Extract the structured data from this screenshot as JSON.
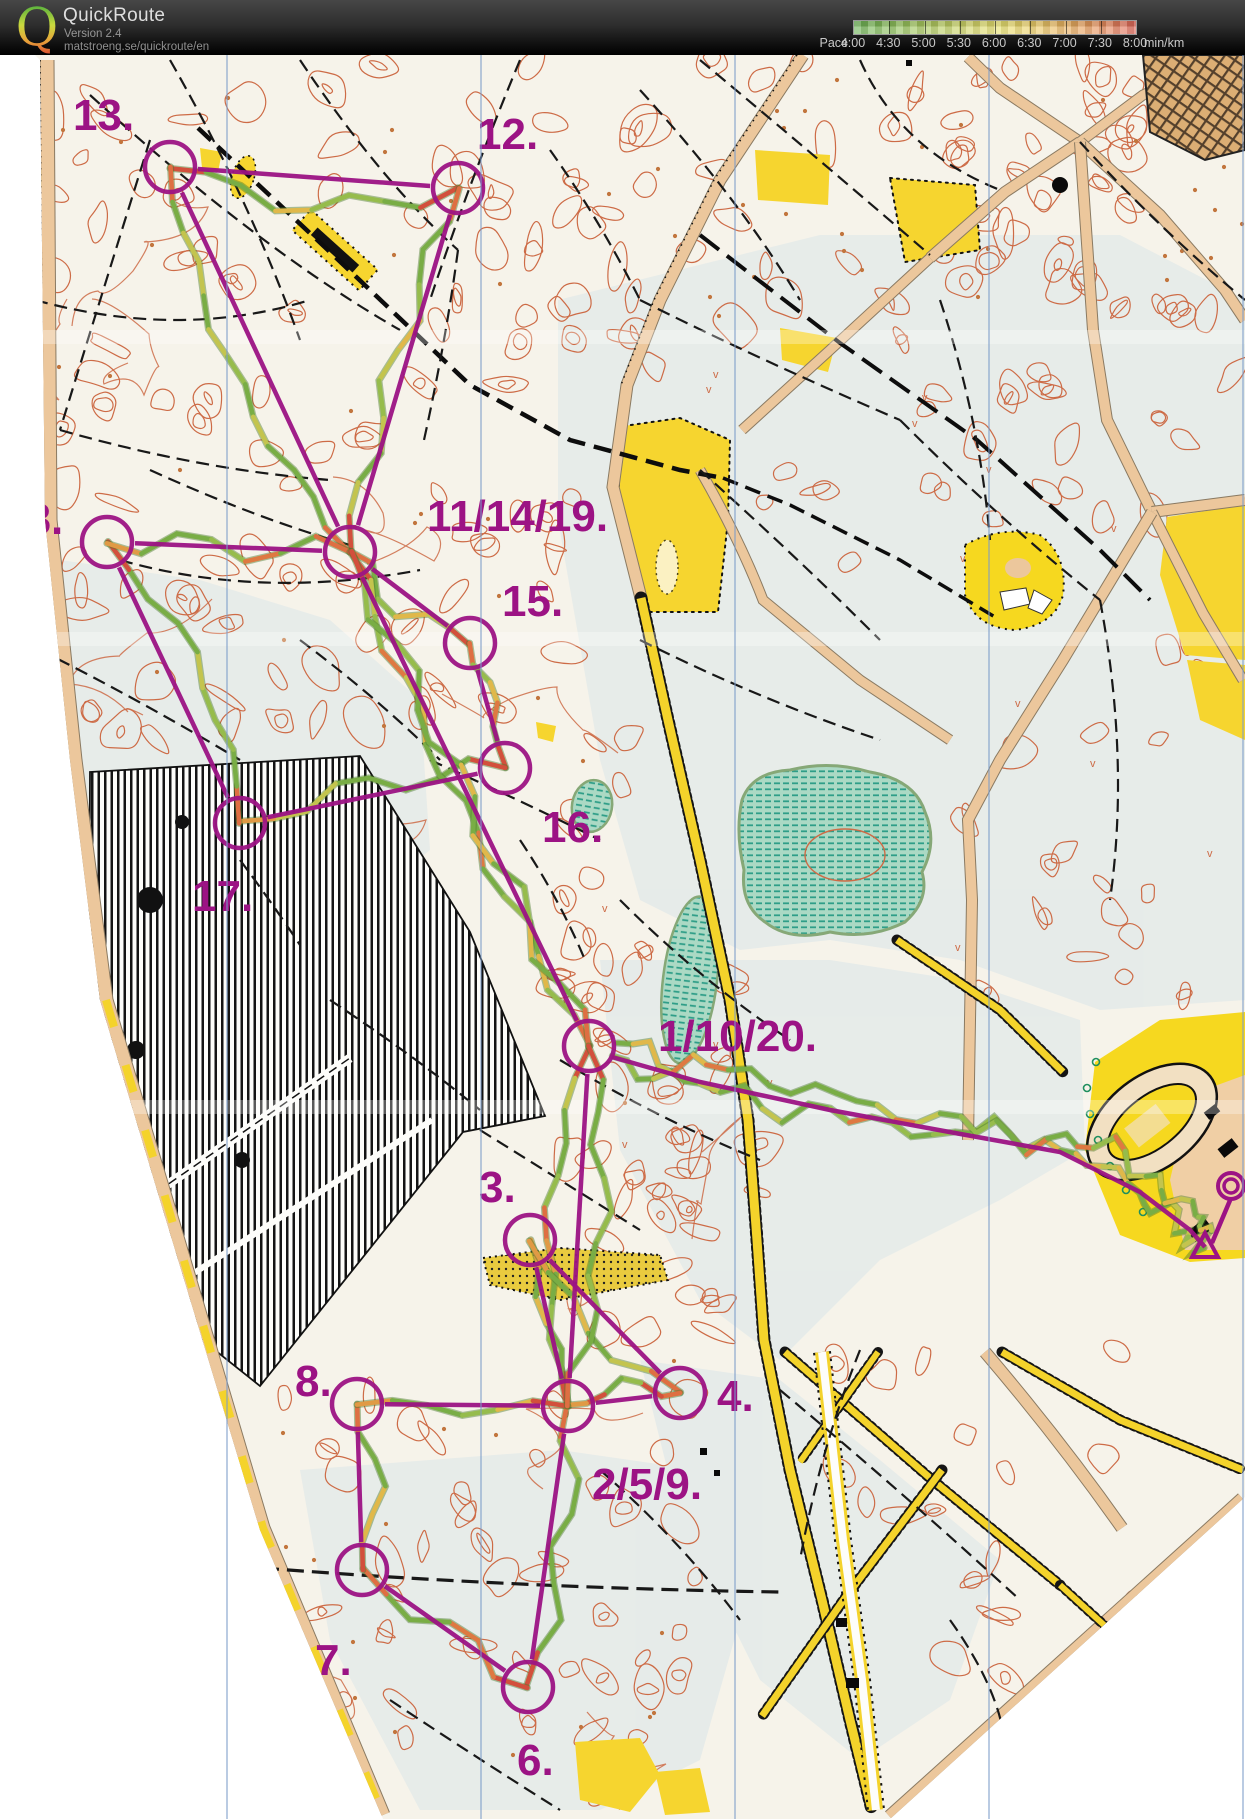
{
  "header": {
    "app_name": "QuickRoute",
    "version": "Version 2.4",
    "url": "matstroeng.se/quickroute/en",
    "logo_letter": "Q",
    "logo_colors": [
      "#2ea43c",
      "#c8d93e",
      "#e8a23a",
      "#d5352c"
    ],
    "pace_legend": {
      "label": "Pace",
      "ticks": [
        "4:00",
        "4:30",
        "5:00",
        "5:30",
        "6:00",
        "6:30",
        "7:00",
        "7:30",
        "8:00"
      ],
      "unit": "min/km",
      "fast_color": "#6cb257",
      "mid_color": "#e9e272",
      "slow_color": "#e0695c"
    }
  },
  "map": {
    "kind": "scanned orienteering map with course overlay",
    "palette": {
      "course": "#9c1384",
      "contour": "#cd6b46",
      "water": "#a9d7c3",
      "water_stripe": "#2f9e88",
      "open_yellow": "#f6d52f",
      "road_tan": "#ecc79c",
      "north_line_blue": "#7b9cc9",
      "track_fast": "#79ad45",
      "track_mid": "#c3c44e",
      "track_slow": "#d2503c"
    },
    "course": {
      "circle_radius": 25,
      "controls": [
        {
          "id": "13",
          "label": "13.",
          "x": 170,
          "y": 167,
          "label_x": 73,
          "label_y": 130
        },
        {
          "id": "12",
          "label": "12.",
          "x": 458,
          "y": 188,
          "label_x": 477,
          "label_y": 149
        },
        {
          "id": "18",
          "label": "18.",
          "x": 107,
          "y": 542,
          "label_x": 2,
          "label_y": 534
        },
        {
          "id": "11/14/19",
          "label": "11/14/19.",
          "x": 350,
          "y": 552,
          "label_x": 427,
          "label_y": 531
        },
        {
          "id": "15",
          "label": "15.",
          "x": 470,
          "y": 643,
          "label_x": 502,
          "label_y": 616
        },
        {
          "id": "16",
          "label": "16.",
          "x": 505,
          "y": 768,
          "label_x": 542,
          "label_y": 842
        },
        {
          "id": "17",
          "label": "17.",
          "x": 240,
          "y": 823,
          "label_x": 192,
          "label_y": 911
        },
        {
          "id": "1/10/20",
          "label": "1/10/20.",
          "x": 589,
          "y": 1046,
          "label_x": 658,
          "label_y": 1051
        },
        {
          "id": "3",
          "label": "3.",
          "x": 530,
          "y": 1240,
          "label_x": 479,
          "label_y": 1202
        },
        {
          "id": "8",
          "label": "8.",
          "x": 357,
          "y": 1404,
          "label_x": 295,
          "label_y": 1396
        },
        {
          "id": "2/5/9",
          "label": "2/5/9.",
          "x": 568,
          "y": 1406,
          "label_x": 592,
          "label_y": 1499
        },
        {
          "id": "4",
          "label": "4.",
          "x": 680,
          "y": 1393,
          "label_x": 717,
          "label_y": 1411
        },
        {
          "id": "7",
          "label": "7.",
          "x": 362,
          "y": 1570,
          "label_x": 315,
          "label_y": 1675
        },
        {
          "id": "6",
          "label": "6.",
          "x": 528,
          "y": 1687,
          "label_x": 517,
          "label_y": 1775
        }
      ],
      "legs": [
        [
          0,
          1
        ],
        [
          1,
          3
        ],
        [
          0,
          3
        ],
        [
          3,
          4
        ],
        [
          4,
          5
        ],
        [
          5,
          6
        ],
        [
          6,
          2
        ],
        [
          2,
          3
        ],
        [
          3,
          7
        ],
        [
          7,
          10
        ],
        [
          10,
          8
        ],
        [
          8,
          11
        ],
        [
          11,
          10
        ],
        [
          10,
          13
        ],
        [
          13,
          12
        ],
        [
          12,
          9
        ],
        [
          9,
          10
        ]
      ],
      "finish_route": [
        [
          612,
          1057
        ],
        [
          700,
          1082
        ],
        [
          830,
          1110
        ],
        [
          955,
          1133
        ],
        [
          1060,
          1152
        ],
        [
          1140,
          1192
        ],
        [
          1190,
          1230
        ],
        [
          1205,
          1247
        ]
      ],
      "start_triangle": {
        "x": 1205,
        "y": 1247
      },
      "finish": {
        "x": 1231,
        "y": 1186
      }
    }
  }
}
